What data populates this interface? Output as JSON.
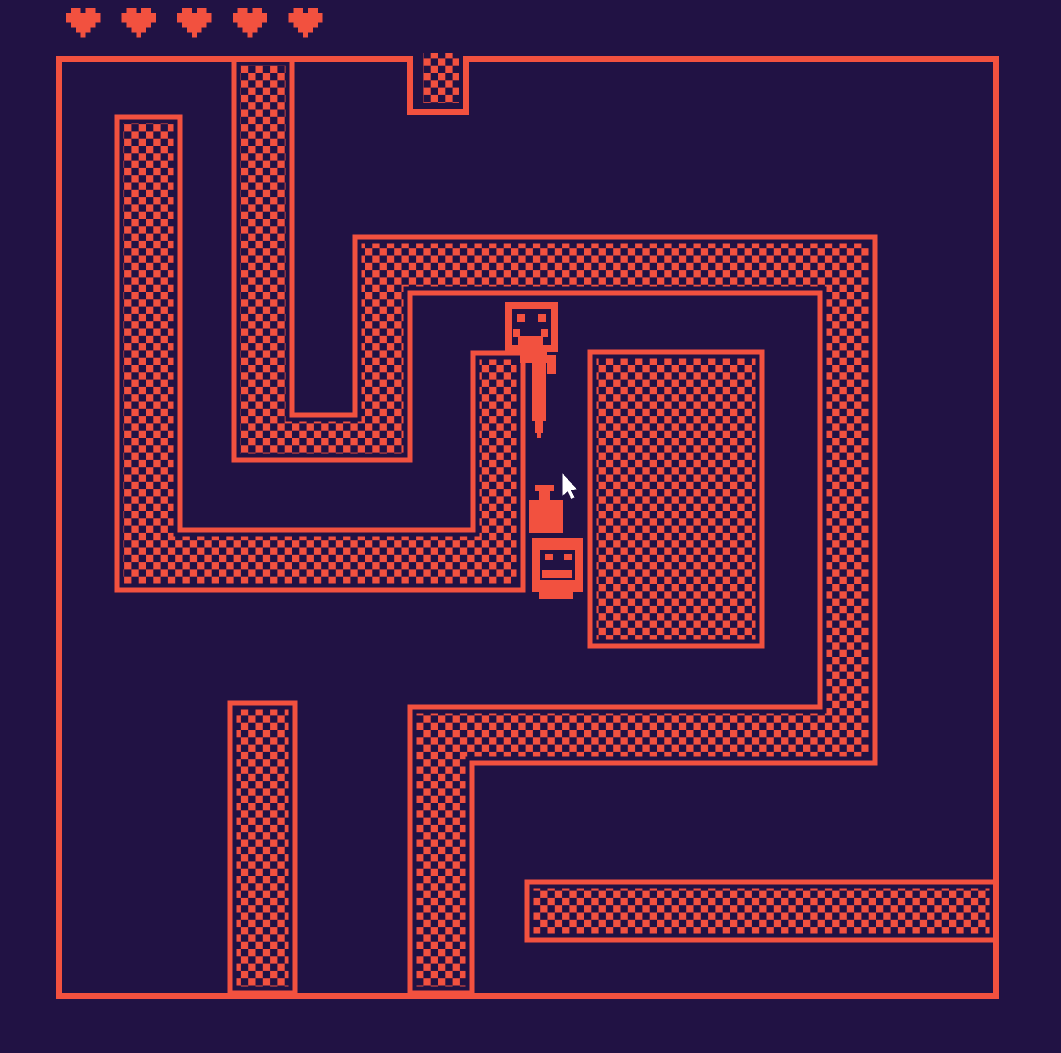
{
  "game": {
    "screen": "maze-room",
    "style": "bitsy-like pixel adventure"
  },
  "palette": {
    "background": "#211244",
    "wall": "#f2513f",
    "cursor_fill": "#ffffff"
  },
  "hud": {
    "hearts_count": 5,
    "heart_icon": "pixel-heart-icon"
  },
  "sprites": {
    "player": "smiley-face-avatar",
    "hanging_item": "sword-item",
    "potion": "bottle-item",
    "statue": "face-altar-statue"
  },
  "cursor": "arrow-cursor",
  "walls": {
    "regions": [
      "left-hook-wall",
      "spiral-wall",
      "center-block",
      "bottom-left-column",
      "bottom-right-band",
      "top-doorway-tile"
    ]
  }
}
